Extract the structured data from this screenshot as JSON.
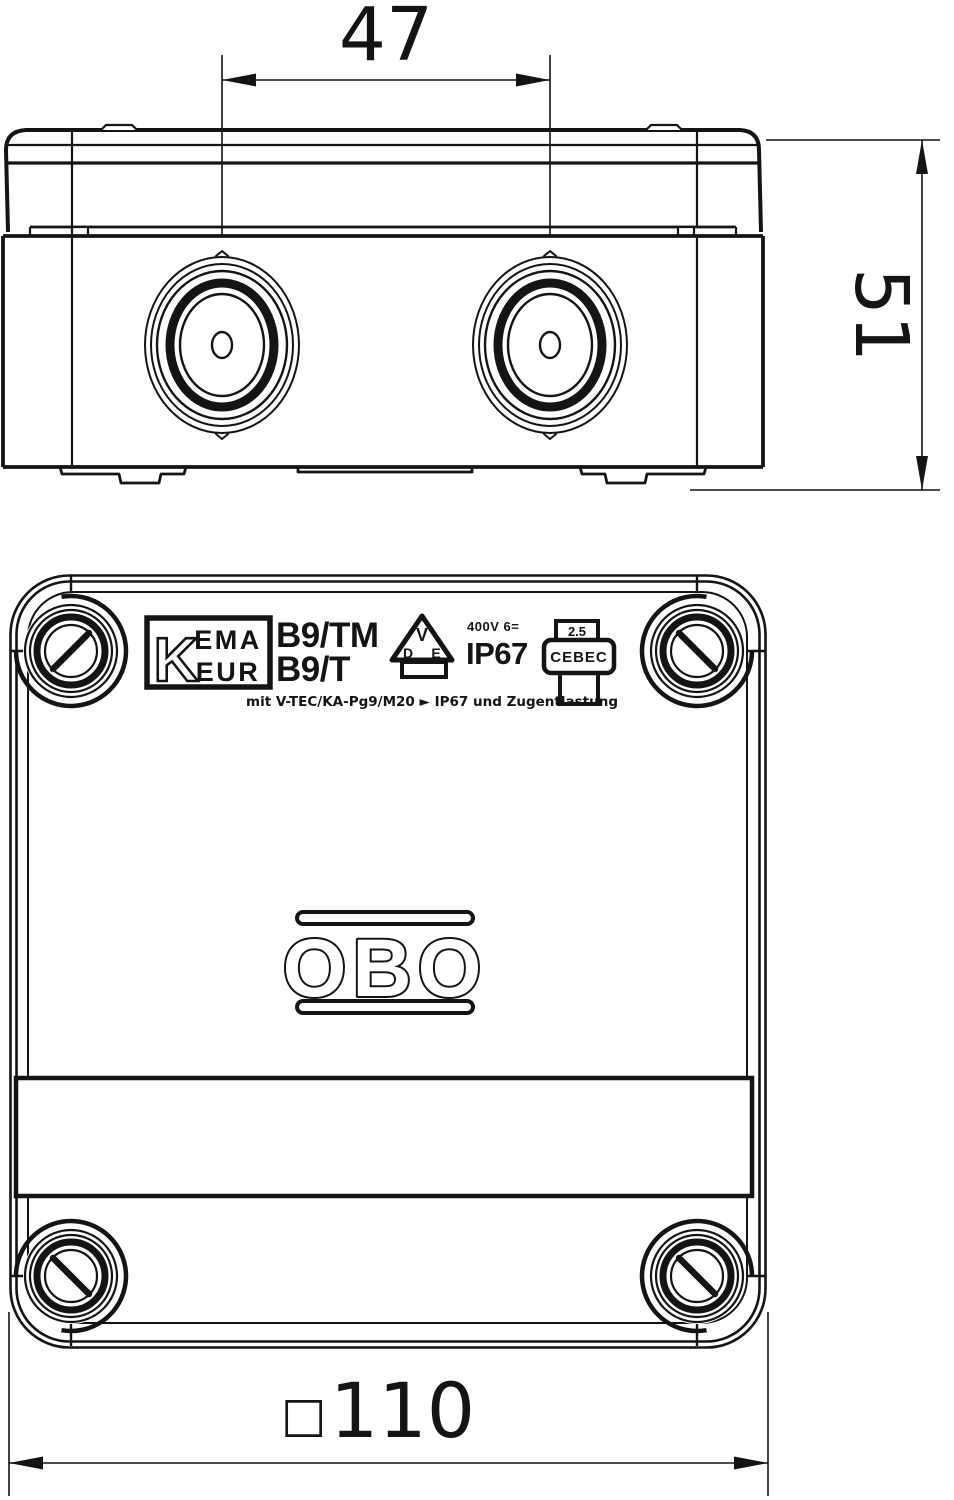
{
  "colors": {
    "line": "#141414",
    "background": "#ffffff"
  },
  "top_view": {
    "width_dim": "47",
    "height_dim": "51"
  },
  "front_view": {
    "kema_k": "K",
    "kema_row1": "EMA",
    "kema_row2": "EUR",
    "model_line1": "B9/TM",
    "model_line2": "B9/T",
    "vde_v": "V",
    "vde_d": "D",
    "vde_e": "E",
    "rating": "400V 6=",
    "ip_rating": "IP67",
    "cebec_value": "2.5",
    "cebec_label": "CEBEC",
    "note": "mit V-TEC/KA-Pg9/M20 ► IP67 und Zugentlastung",
    "brand": "OBO",
    "bottom_dim_prefix": "□",
    "bottom_dim": "110"
  }
}
